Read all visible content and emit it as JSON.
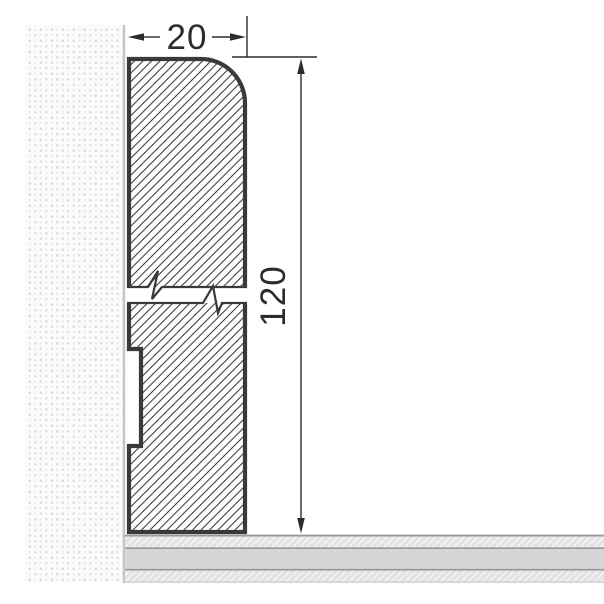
{
  "drawing": {
    "type": "technical-cross-section",
    "subject": "skirting-board profile mounted on wall above floor",
    "dimensions": {
      "width": {
        "label": "20"
      },
      "height": {
        "label": "120"
      }
    },
    "colors": {
      "outline": "#3a3a3a",
      "hatch_line": "#3f3f3f",
      "dimension": "#2c2c2c",
      "wall_dot": "#dcdcdc",
      "wall_edge": "#c5c5c5",
      "floor_line": "#9a9a9a",
      "floor_band": "#d6d6d6",
      "floor_hatch_bg": "#e3e3e3",
      "background": "#ffffff"
    }
  }
}
